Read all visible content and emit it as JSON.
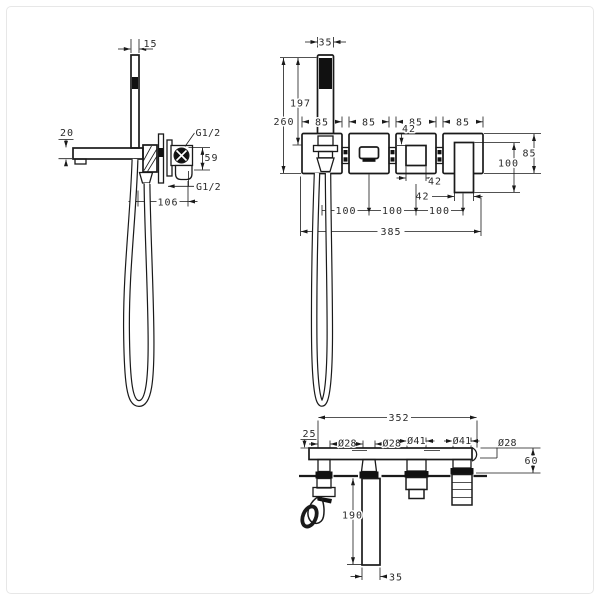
{
  "drawing": {
    "type": "technical-dimension-drawing",
    "subject": "wall-mounted bath mixer with hand shower",
    "colors": {
      "line": "#1a1a1a",
      "fill": "#111111",
      "background": "#ffffff",
      "frame_border": "#e7e7e7"
    },
    "side_view": {
      "dims": {
        "holder_bar_width": "15",
        "spout_height": "20",
        "top_connection": "G1/2",
        "connection_offset": "59",
        "bottom_connection": "G1/2",
        "wall_depth": "106"
      }
    },
    "front_view": {
      "dims": {
        "handshower_width": "35",
        "handshower_length": "197",
        "overall_height": "260",
        "plate1_width": "85",
        "plate2_width": "85",
        "plate3_width": "85",
        "plate4_width": "85",
        "valve_inner_height": "42",
        "valve_inner_width": "42",
        "handle_width": "42",
        "spacing_1": "100",
        "spacing_2": "100",
        "spacing_3": "100",
        "overall_width": "385",
        "plate_height": "85",
        "handle_length": "100"
      }
    },
    "bottom_view": {
      "dims": {
        "plate_width": "352",
        "edge_offset": "25",
        "hole1_diameter": "Ø28",
        "hole2_diameter": "Ø28",
        "hole3_diameter": "Ø41",
        "hole4_diameter": "Ø41",
        "hole5_diameter": "Ø28",
        "plate_depth": "60",
        "spout_reach": "190",
        "spout_width": "35"
      }
    }
  }
}
